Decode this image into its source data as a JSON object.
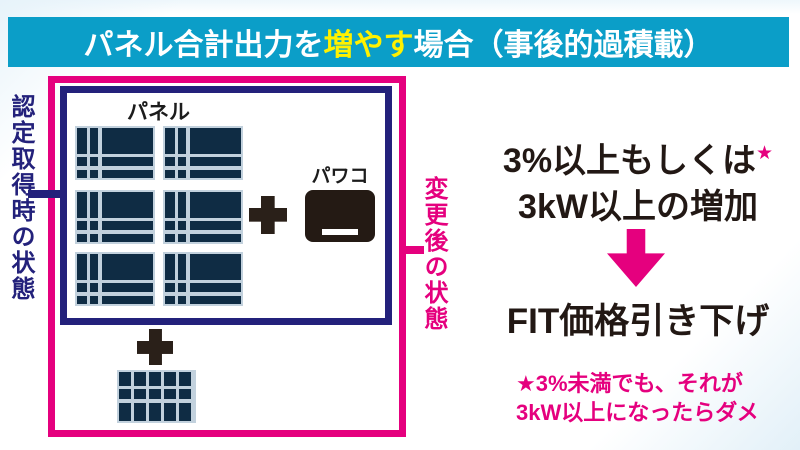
{
  "colors": {
    "cyan": "#0b9ec8",
    "pink": "#e5007e",
    "navy": "#23217b",
    "yellow": "#fff100",
    "ink": "#221814",
    "ink2": "#2a2019",
    "panel_fill": "#0f2c44",
    "panel_line": "#c2d1dd"
  },
  "title": {
    "part1": "パネル合計出力を",
    "highlight": "増やす",
    "part2": "場合（事後的過積載）"
  },
  "diagram": {
    "left_label": "認定取得時の状態",
    "right_label": "変更後の状態",
    "panel_label": "パネル",
    "inverter_label": "パワコン",
    "icons": [
      "plus-icon",
      "plus-icon",
      "solar-panel",
      "power-conditioner"
    ]
  },
  "result": {
    "condition_line1": "3%以上もしくは",
    "condition_star": "★",
    "condition_line2": "3kW以上の増加",
    "arrow_icon": "down-arrow-icon",
    "outcome": "FIT価格引き下げ",
    "note_line1": "★3%未満でも、それが",
    "note_line2": "3kW以上になったらダメ"
  }
}
